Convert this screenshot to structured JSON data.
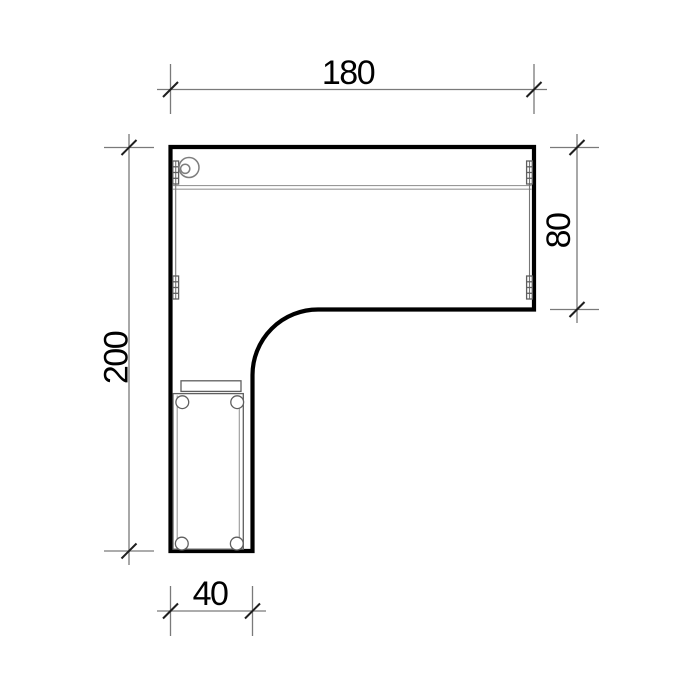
{
  "drawing": {
    "dimensions": {
      "top": "180",
      "right": "80",
      "left": "200",
      "bottom": "40"
    },
    "colors": {
      "background": "#ffffff",
      "outline": "#000000",
      "dimline": "#7a7a7a",
      "tick": "#1f1f1f",
      "detail": "#5f5f5f",
      "faint": "#989898",
      "label": "#000000"
    }
  }
}
